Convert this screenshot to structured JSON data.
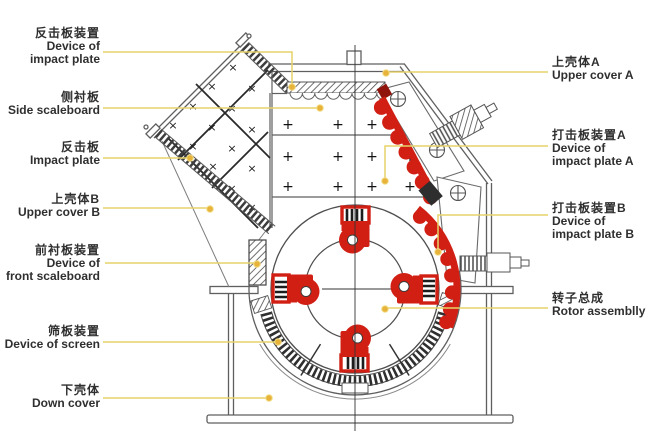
{
  "diagram": {
    "kind": "impact-crusher-sectional-diagram",
    "labels": {
      "l1": {
        "cn": "反击板装置",
        "en1": "Device of",
        "en2": "impact plate"
      },
      "l2": {
        "cn": "侧衬板",
        "en1": "Side scaleboard"
      },
      "l3": {
        "cn": "反击板",
        "en1": "Impact plate"
      },
      "l4": {
        "cn": "上壳体B",
        "en1": "Upper cover B"
      },
      "l5": {
        "cn": "前衬板装置",
        "en1": "Device of",
        "en2": "front scaleboard"
      },
      "l6": {
        "cn": "筛板装置",
        "en1": "Device of screen"
      },
      "l7": {
        "cn": "下壳体",
        "en1": "Down cover"
      },
      "r1": {
        "cn": "上壳体A",
        "en1": "Upper cover A"
      },
      "r2": {
        "cn": "打击板装置A",
        "en1": "Device of",
        "en2": "impact plate A"
      },
      "r3": {
        "cn": "打击板装置B",
        "en1": "Device of",
        "en2": "impact plate B"
      },
      "r4": {
        "cn": "转子总成",
        "en1": "Rotor assemblly"
      }
    },
    "colors": {
      "leader_line": "#e6d469",
      "leader_dot": "#e8b33b",
      "part_red": "#d11f14",
      "drawing_line": "#5f5f5f"
    }
  }
}
